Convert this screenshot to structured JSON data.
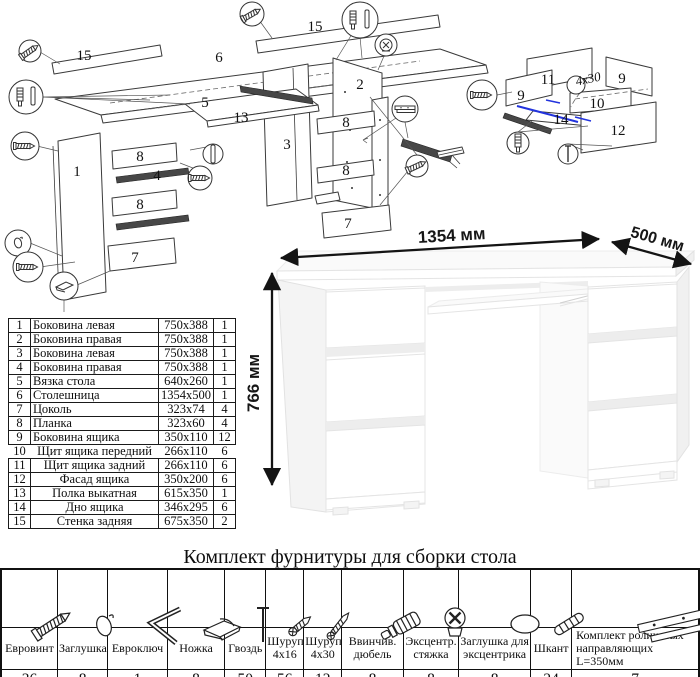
{
  "main_diagram": {
    "labels": [
      "15",
      "6",
      "15",
      "5",
      "13",
      "2",
      "3",
      "1",
      "8",
      "4",
      "8",
      "7",
      "8",
      "8",
      "7"
    ]
  },
  "drawer_diagram": {
    "labels": [
      "11",
      "9",
      "9",
      "10",
      "14",
      "12"
    ],
    "screw_note": "4x30"
  },
  "desk": {
    "dim_width": "1354 мм",
    "dim_depth": "500 мм",
    "dim_height": "766 мм"
  },
  "parts_table": {
    "rows": [
      {
        "num": "1",
        "name": "Боковина левая",
        "size": "750x388",
        "qty": "1"
      },
      {
        "num": "2",
        "name": "Боковина правая",
        "size": "750x388",
        "qty": "1"
      },
      {
        "num": "3",
        "name": "Боковина левая",
        "size": "750x388",
        "qty": "1"
      },
      {
        "num": "4",
        "name": "Боковина правая",
        "size": "750x388",
        "qty": "1"
      },
      {
        "num": "5",
        "name": "Вязка стола",
        "size": "640x260",
        "qty": "1"
      },
      {
        "num": "6",
        "name": "Столешница",
        "size": "1354x500",
        "qty": "1"
      },
      {
        "num": "7",
        "name": "Цоколь",
        "size": "323x74",
        "qty": "4"
      },
      {
        "num": "8",
        "name": "Планка",
        "size": "323x60",
        "qty": "4"
      },
      {
        "num": "9",
        "name": "Боковина ящика",
        "size": "350x110",
        "qty": "12"
      },
      {
        "num": "10",
        "name": "Щит ящика передний",
        "size": "266x110",
        "qty": "6"
      },
      {
        "num": "11",
        "name": "Щит ящика задний",
        "size": "266x110",
        "qty": "6"
      },
      {
        "num": "12",
        "name": "Фасад ящика",
        "size": "350x200",
        "qty": "6"
      },
      {
        "num": "13",
        "name": "Полка выкатная",
        "size": "615x350",
        "qty": "1"
      },
      {
        "num": "14",
        "name": "Дно ящика",
        "size": "346x295",
        "qty": "6"
      },
      {
        "num": "15",
        "name": "Стенка задняя",
        "size": "675x350",
        "qty": "2"
      }
    ]
  },
  "hardware": {
    "title": "Комплект фурнитуры для сборки стола",
    "items": [
      {
        "name": "Евровинт",
        "qty": "36",
        "icon": "euro-screw-icon"
      },
      {
        "name": "Заглушка",
        "qty": "8",
        "icon": "cap-icon"
      },
      {
        "name": "Евроключ",
        "qty": "1",
        "icon": "hex-key-icon"
      },
      {
        "name": "Ножка",
        "qty": "8",
        "icon": "foot-icon"
      },
      {
        "name": "Гвоздь",
        "qty": "50",
        "icon": "nail-icon"
      },
      {
        "name": "Шуруп 4x16",
        "qty": "56",
        "icon": "screw-short-icon"
      },
      {
        "name": "Шуруп 4x30",
        "qty": "12",
        "icon": "screw-long-icon"
      },
      {
        "name": "Ввинчив. дюбель",
        "qty": "8",
        "icon": "threaded-dowel-icon"
      },
      {
        "name": "Эксцентр. стяжка",
        "qty": "8",
        "icon": "cam-lock-icon"
      },
      {
        "name": "Заглушка для эксцентрика",
        "qty": "8",
        "icon": "cam-cap-icon"
      },
      {
        "name": "Шкант",
        "qty": "24",
        "icon": "wood-dowel-icon"
      },
      {
        "name": "Комплект роликовых направляющих L=350мм",
        "qty": "7",
        "icon": "drawer-rail-icon"
      }
    ]
  }
}
